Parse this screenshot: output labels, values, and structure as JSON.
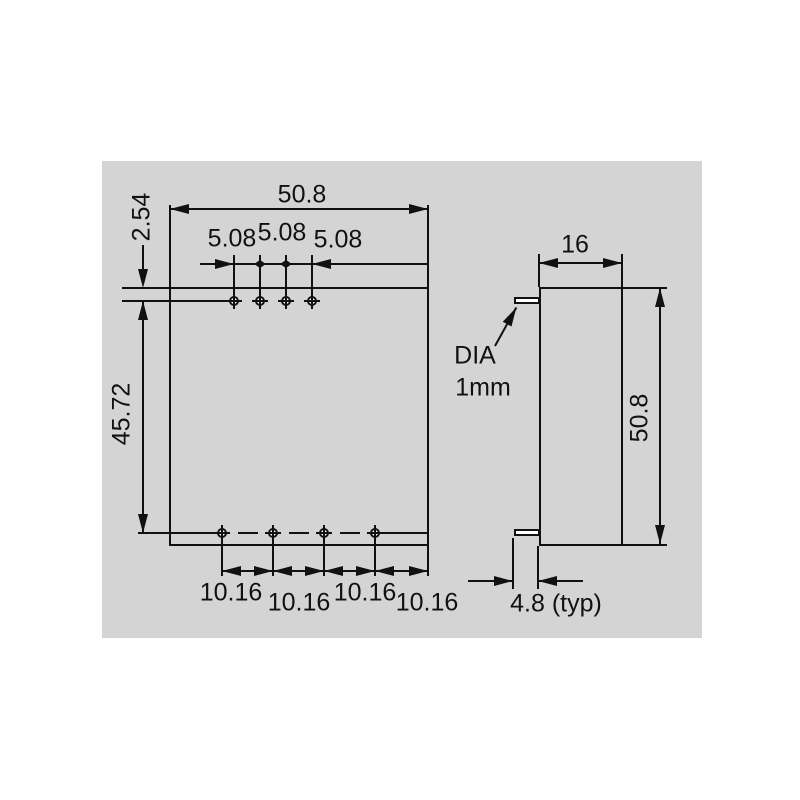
{
  "front_view": {
    "overall_width": "50.8",
    "top_pin_offset": "2.54",
    "top_pin_pitch": [
      "5.08",
      "5.08",
      "5.08"
    ],
    "pin_row_span": "45.72",
    "bottom_pin_pitch": [
      "10.16",
      "10.16",
      "10.16",
      "10.16"
    ]
  },
  "side_view": {
    "depth": "16",
    "height": "50.8",
    "pin_diameter_label_line1": "DIA",
    "pin_diameter_label_line2": "1mm",
    "pin_protrusion": "4.8 (typ)"
  },
  "colors": {
    "canvas_background": "#d4d4d4",
    "line": "#111111",
    "page_background": "#ffffff"
  }
}
